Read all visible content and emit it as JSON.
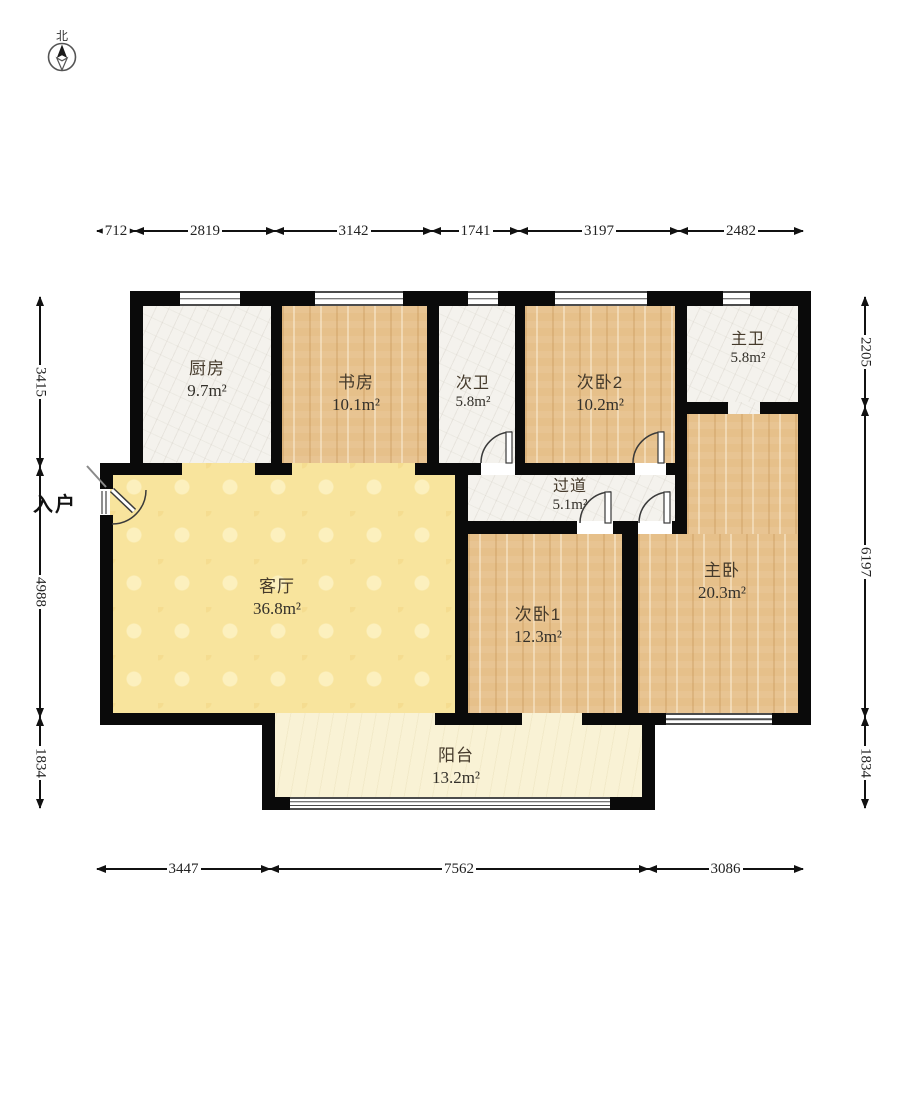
{
  "compass": {
    "label": "北"
  },
  "entrance_label": "入户",
  "rooms": {
    "kitchen": {
      "name": "厨房",
      "area": "9.7m²"
    },
    "study": {
      "name": "书房",
      "area": "10.1m²"
    },
    "bath2": {
      "name": "次卫",
      "area": "5.8m²"
    },
    "bedroom2": {
      "name": "次卧2",
      "area": "10.2m²"
    },
    "master_bath": {
      "name": "主卫",
      "area": "5.8m²"
    },
    "hallway": {
      "name": "过道",
      "area": "5.1m²"
    },
    "living": {
      "name": "客厅",
      "area": "36.8m²"
    },
    "bedroom1": {
      "name": "次卧1",
      "area": "12.3m²"
    },
    "master_bedroom": {
      "name": "主卧",
      "area": "20.3m²"
    },
    "balcony": {
      "name": "阳台",
      "area": "13.2m²"
    }
  },
  "dimensions": {
    "top": [
      "712",
      "2819",
      "3142",
      "1741",
      "3197",
      "2482"
    ],
    "bottom": [
      "3447",
      "7562",
      "3086"
    ],
    "left": [
      "3415",
      "4988",
      "1834"
    ],
    "right": [
      "2205",
      "6197",
      "1834"
    ]
  },
  "colors": {
    "wall": "#0a0a0a",
    "wood_floor": "#e6c08a",
    "tile_floor": "#f4f2ed",
    "living_floor": "#f8e49d",
    "balcony_floor": "#f9f2d5"
  }
}
